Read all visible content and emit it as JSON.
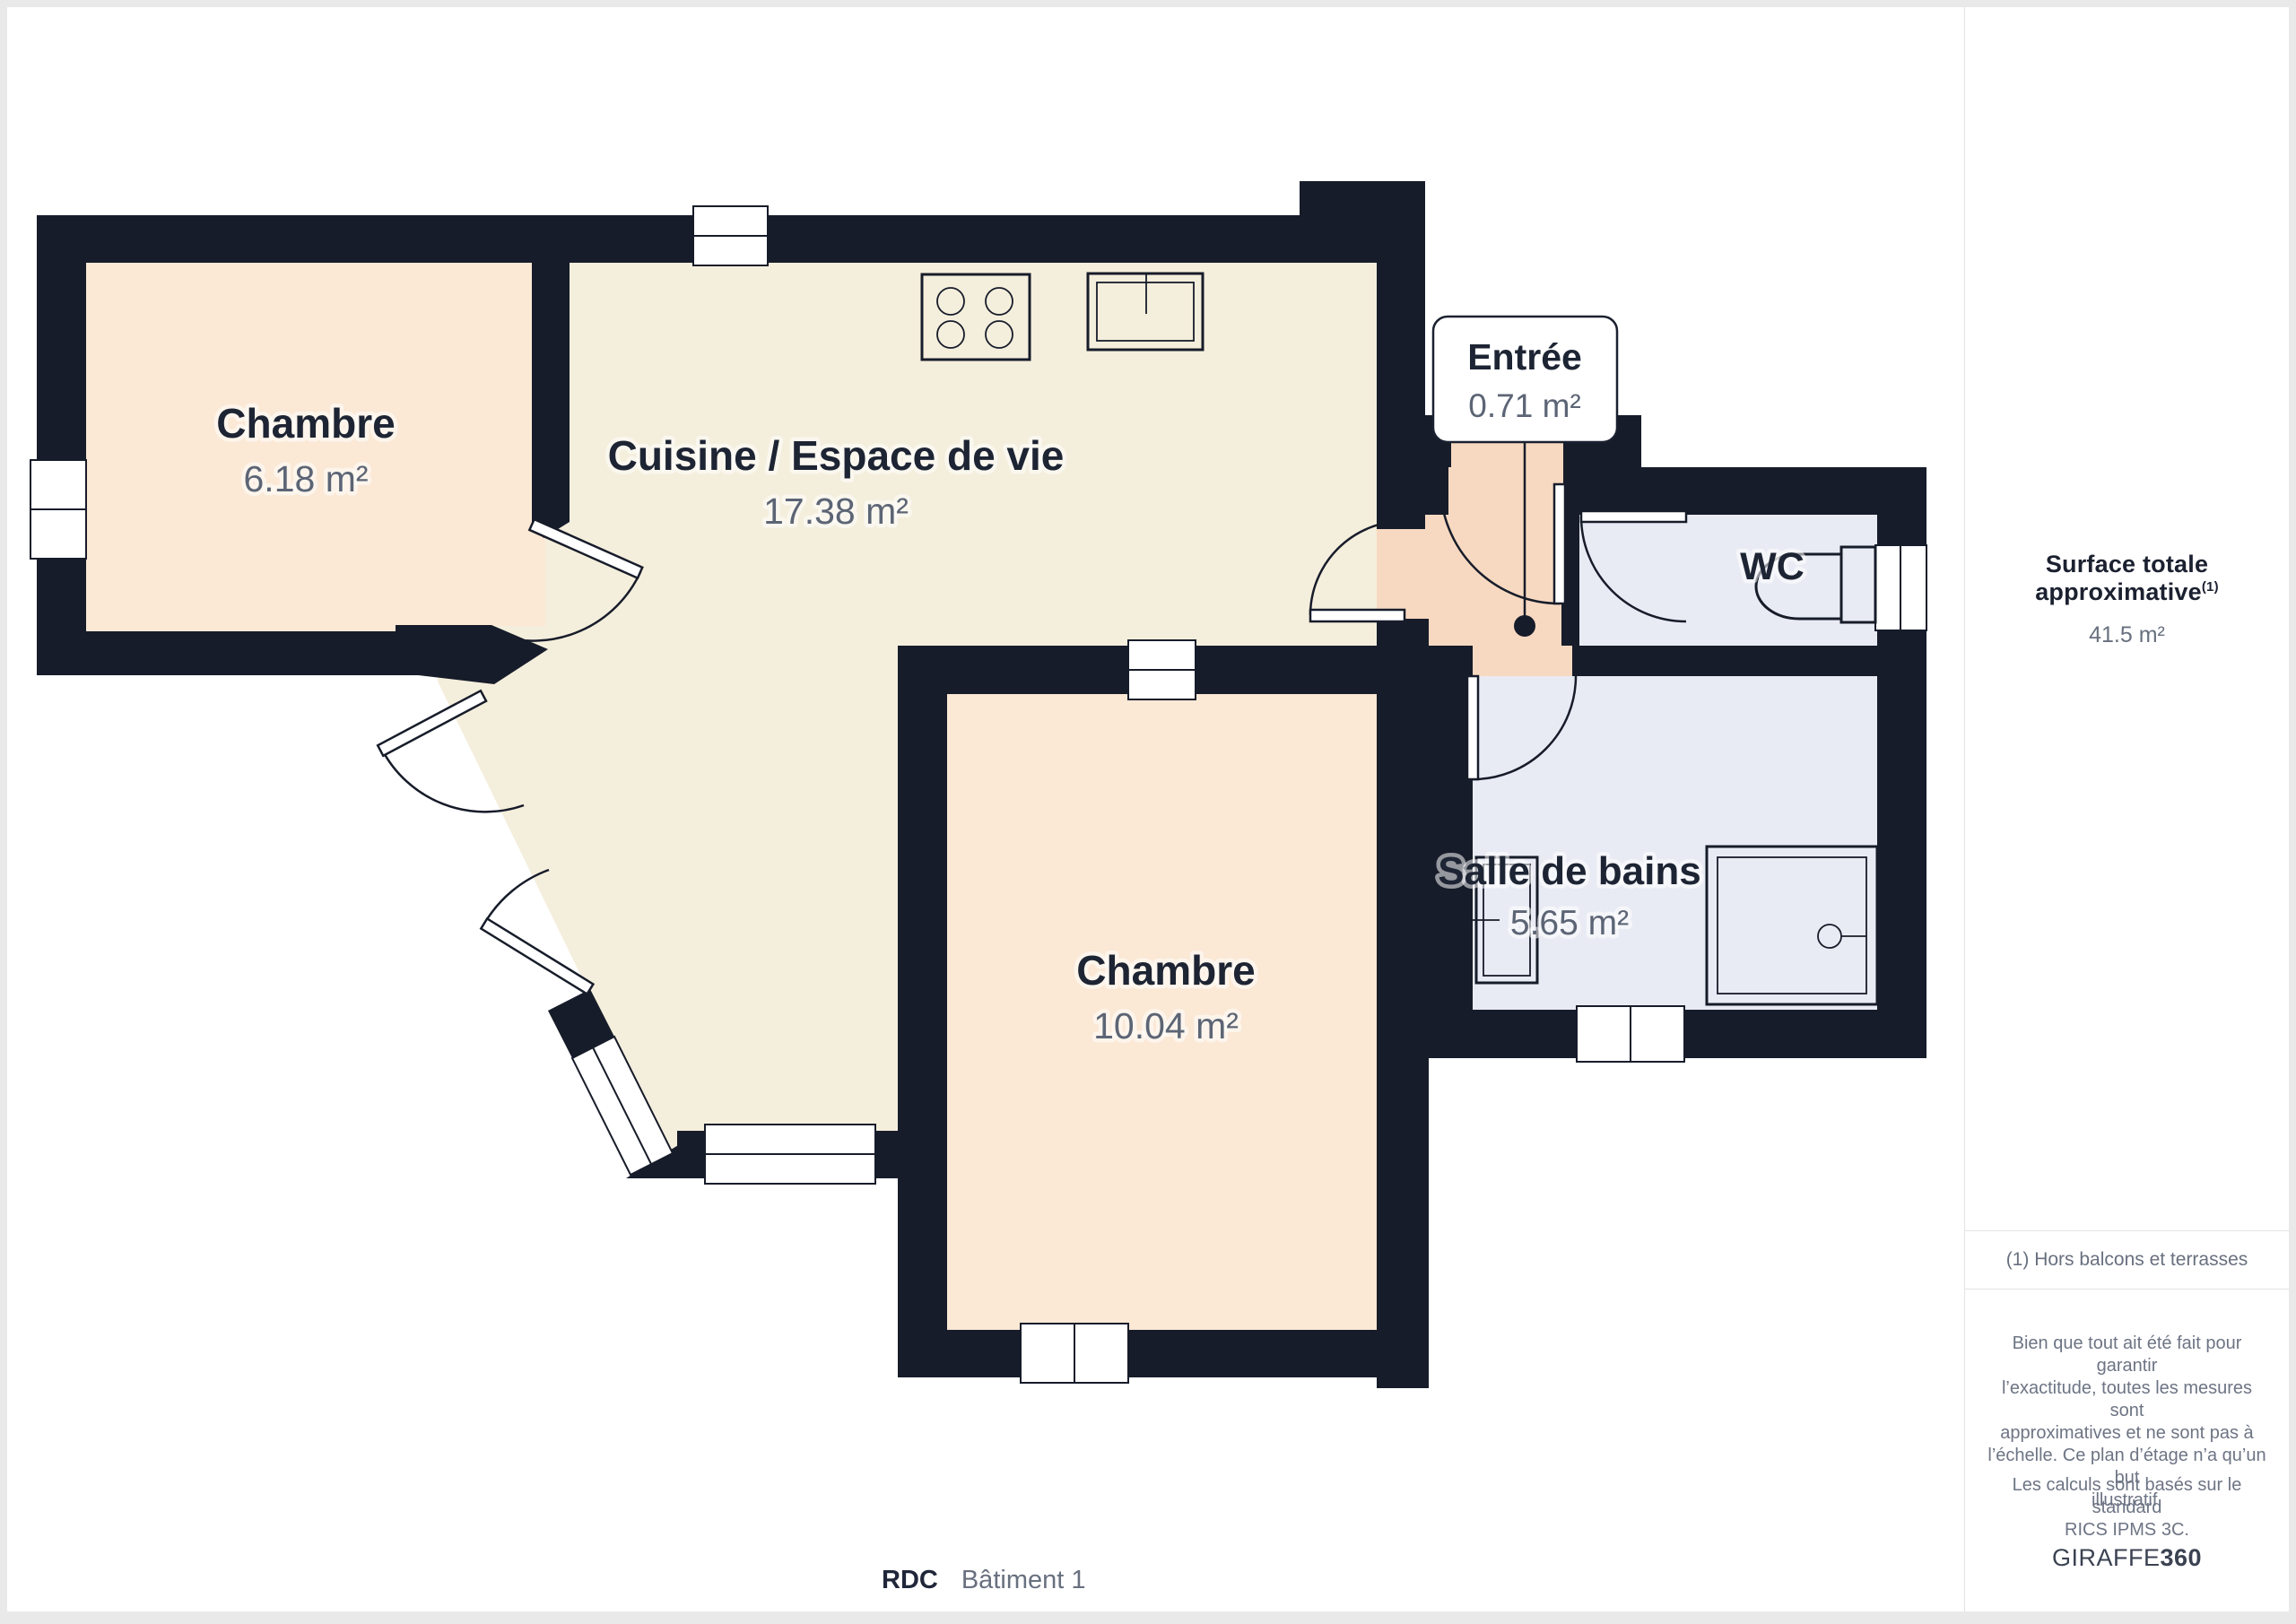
{
  "floorplan": {
    "floor_label": "RDC",
    "building_label": "Bâtiment 1",
    "rooms": {
      "chambre1": {
        "name": "Chambre",
        "area": "6.18 m²"
      },
      "cuisine": {
        "name": "Cuisine / Espace de vie",
        "area": "17.38 m²"
      },
      "chambre2": {
        "name": "Chambre",
        "area": "10.04 m²"
      },
      "salle_de_bains": {
        "name": "Salle de bains",
        "area": "5.65 m²"
      },
      "wc": {
        "name": "WC"
      },
      "entree": {
        "name": "Entrée",
        "area": "0.71 m²"
      }
    },
    "fixtures": [
      "stove-icon",
      "sink-icon",
      "toilet-icon",
      "washbasin-icon",
      "shower-icon"
    ],
    "colors": {
      "walls": "#171c2a",
      "bedroom_fill": "#fbe8d5",
      "living_fill": "#f4eedc",
      "entry_fill": "#f7d9c1",
      "wet_room_fill": "#e9ebf4",
      "room_name_text": "#1d2433",
      "room_area_text": "#5c6575"
    }
  },
  "sidebar": {
    "surface_title": "Surface totale approximative",
    "surface_sup": "(1)",
    "surface_value": "41.5 m²",
    "footnote": "(1) Hors balcons et terrasses",
    "disclaimer": "Bien que tout ait été fait pour garantir\nl’exactitude, toutes les mesures sont\napproximatives et ne sont pas à\nl’échelle. Ce plan d’étage n’a qu’un but\nillustratif.",
    "standard": "Les calculs sont basés sur le standard\nRICS IPMS 3C.",
    "brand_regular": "GIRAFFE",
    "brand_bold": "360"
  }
}
